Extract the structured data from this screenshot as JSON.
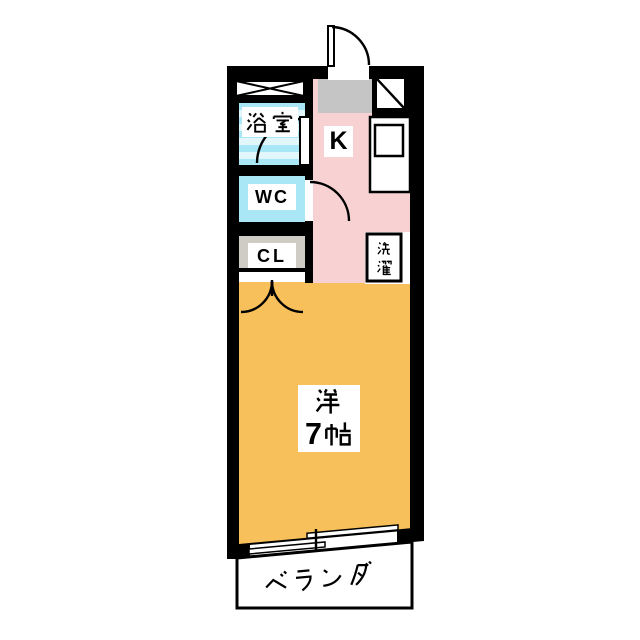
{
  "rooms": {
    "bathroom": {
      "label": "浴室"
    },
    "toilet": {
      "label": "WC"
    },
    "closet": {
      "label": "CL"
    },
    "kitchen": {
      "label": "K"
    },
    "laundry": {
      "label": "洗濯"
    },
    "main_room": {
      "label_line1": "洋",
      "label_line2": "7帖"
    },
    "veranda": {
      "label": "ベランダ"
    }
  },
  "colors": {
    "wall": "#000000",
    "kitchen": "#f8d2d2",
    "main_room": "#f7c05a",
    "bathroom_stripe_a": "#a9e7f7",
    "bathroom_stripe_b": "#e2f7fc",
    "toilet": "#a9e7f7",
    "closet": "#cfccc5",
    "entry": "#c5c5c5",
    "veranda": "#ffffff",
    "fixture": "#ffffff"
  }
}
